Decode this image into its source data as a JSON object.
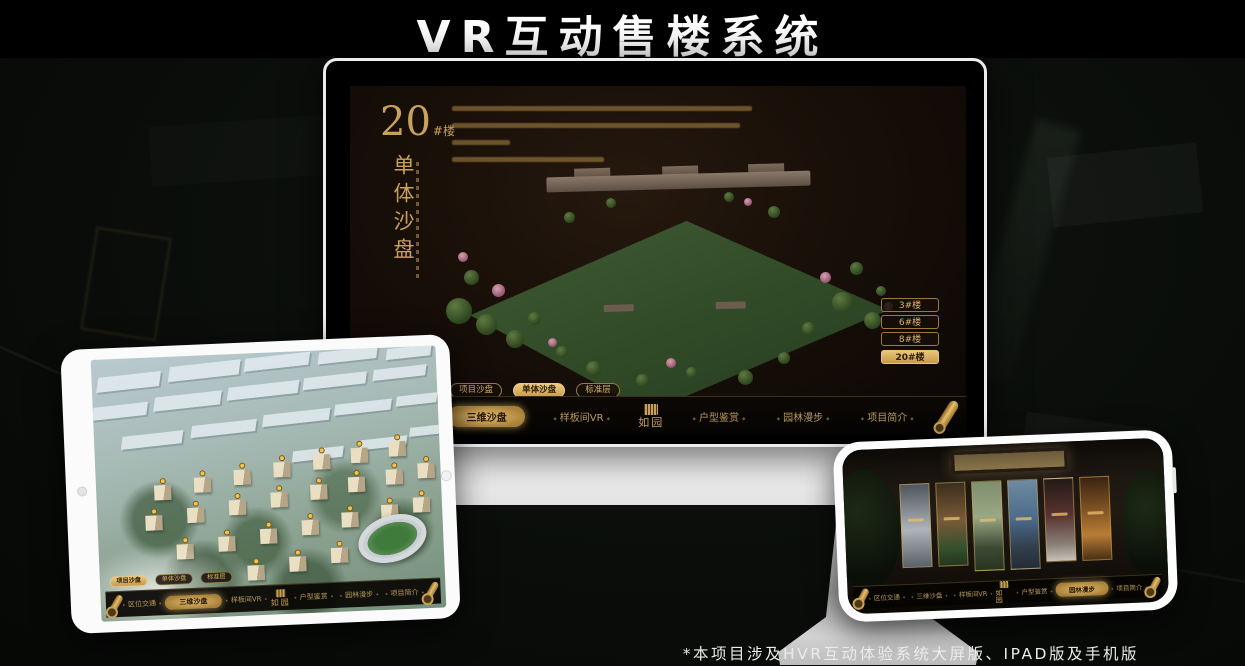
{
  "title": "VR互动售楼系统",
  "footnote": "*本项目涉及HVR互动体验系统大屏版、IPAD版及手机版",
  "colors": {
    "gold": "#c9a15b",
    "gold_bright": "#e8c273",
    "screen_bg": "#180f08",
    "nav_bg": "#080503",
    "title_color": "#ffffff"
  },
  "desktop": {
    "unit_number": "20",
    "unit_suffix": "#楼",
    "panel_title": "单体沙盘",
    "building_buttons": [
      "3#楼",
      "6#楼",
      "8#楼",
      "20#楼"
    ],
    "active_building": "20#楼",
    "tabs": [
      "项目沙盘",
      "单体沙盘",
      "标准层"
    ],
    "active_tab": "单体沙盘",
    "nav": {
      "left": [
        "区位交通",
        "三维沙盘",
        "样板间VR"
      ],
      "right": [
        "户型鉴赏",
        "园林漫步",
        "项目简介"
      ],
      "active": "三维沙盘",
      "logo": "如园"
    }
  },
  "tablet": {
    "tabs": [
      "项目沙盘",
      "单体沙盘",
      "标准层"
    ],
    "active_tab": "项目沙盘",
    "nav": {
      "left": [
        "区位交通",
        "三维沙盘",
        "样板间VR"
      ],
      "right": [
        "户型鉴赏",
        "园林漫步",
        "项目简介"
      ],
      "active": "三维沙盘",
      "logo": "如园"
    }
  },
  "phone": {
    "nav": {
      "left": [
        "区位交通",
        "三维沙盘",
        "样板间VR"
      ],
      "right": [
        "户型鉴赏",
        "园林漫步",
        "项目简介"
      ],
      "active": "园林漫步",
      "logo": "如园"
    }
  }
}
